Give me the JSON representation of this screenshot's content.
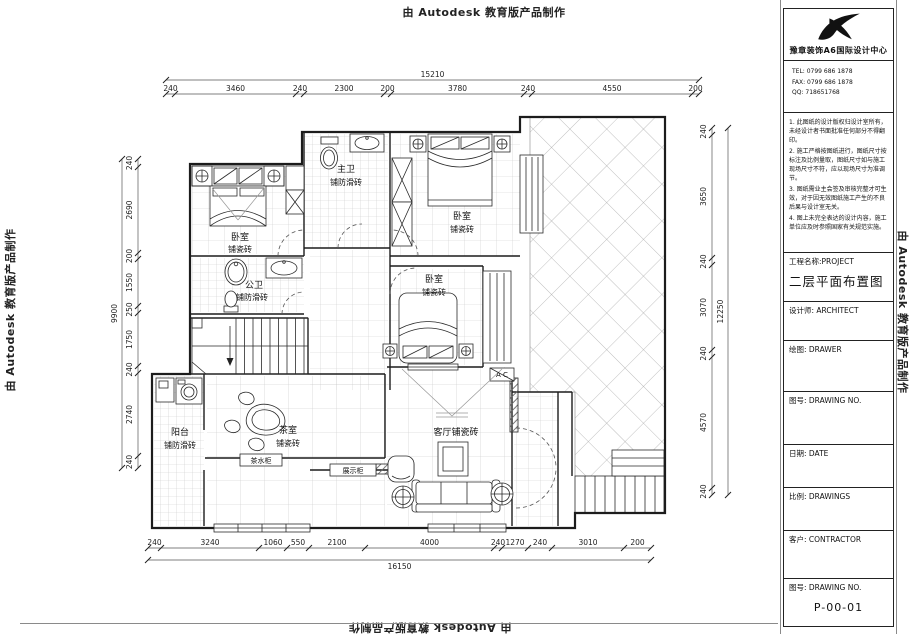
{
  "watermark": {
    "text": "由 Autodesk 教育版产品制作"
  },
  "title_block": {
    "company": "豫章装饰A6国际设计中心",
    "tel": "TEL: 0799 686 1878",
    "fax": "FAX: 0799 686 1878",
    "qq": "QQ:  718651768",
    "notes": [
      "1. 此图纸的设计版权归设计室所有，未经设计者书面批准任何部分不得翻印。",
      "2. 施工严格按图纸进行，图纸尺寸按标注及比例量取，图纸尺寸如与施工现场尺寸不符，应以现场尺寸为准调节。",
      "3. 图纸需业主会签及审核完整才可生效，对于因无效图纸施工产生的不良后果与设计室无关。",
      "4. 图上未完全表达的设计内容，施工单位应及时参照国家有关规范实施。"
    ],
    "project_label": "工程名称:PROJECT",
    "project_name": "二层平面布置图",
    "architect": "设计师: ARCHITECT",
    "drawer": "绘图: DRAWER",
    "drawing_no_label": "图号: DRAWING NO.",
    "date": "日期: DATE",
    "scale": "比例: DRAWINGS",
    "contractor": "客户: CONTRACTOR",
    "drawing_no_label2": "图号: DRAWING NO.",
    "drawing_no": "P-00-01"
  },
  "plan": {
    "dims": {
      "top_total": "15210",
      "top": [
        "240",
        "3460",
        "240",
        "2300",
        "200",
        "3780",
        "240",
        "4550",
        "200"
      ],
      "bottom": [
        "240",
        "3240",
        "1060",
        "550",
        "2100",
        "4000",
        "240",
        "1270",
        "240",
        "3010",
        "200"
      ],
      "bottom_total": "16150",
      "left": [
        "240",
        "2690",
        "200",
        "1550",
        "250",
        "1750",
        "240",
        "2740",
        "240"
      ],
      "left_total": "9900",
      "right": [
        "240",
        "3650",
        "240",
        "3070",
        "240",
        "4570",
        "240"
      ],
      "right_total": "12250"
    },
    "rooms": {
      "bedroom_tl": {
        "name": "卧室",
        "floor": "铺瓷砖"
      },
      "master_bath": {
        "name": "主卫",
        "floor": "铺防滑砖"
      },
      "bedroom_tr": {
        "name": "卧室",
        "floor": "铺瓷砖"
      },
      "public_bath": {
        "name": "公卫",
        "floor": "铺防滑砖"
      },
      "bedroom_mid": {
        "name": "卧室",
        "floor": "铺瓷砖"
      },
      "balcony": {
        "name": "阳台",
        "floor": "铺防滑砖"
      },
      "tea_room": {
        "name": "茶室",
        "floor": "铺瓷砖"
      },
      "living_room": {
        "name": "客厅铺瓷砖"
      }
    },
    "labels": {
      "tea_cabinet": "茶水柜",
      "display_cabinet": "展示柜",
      "ac": "A C"
    }
  }
}
